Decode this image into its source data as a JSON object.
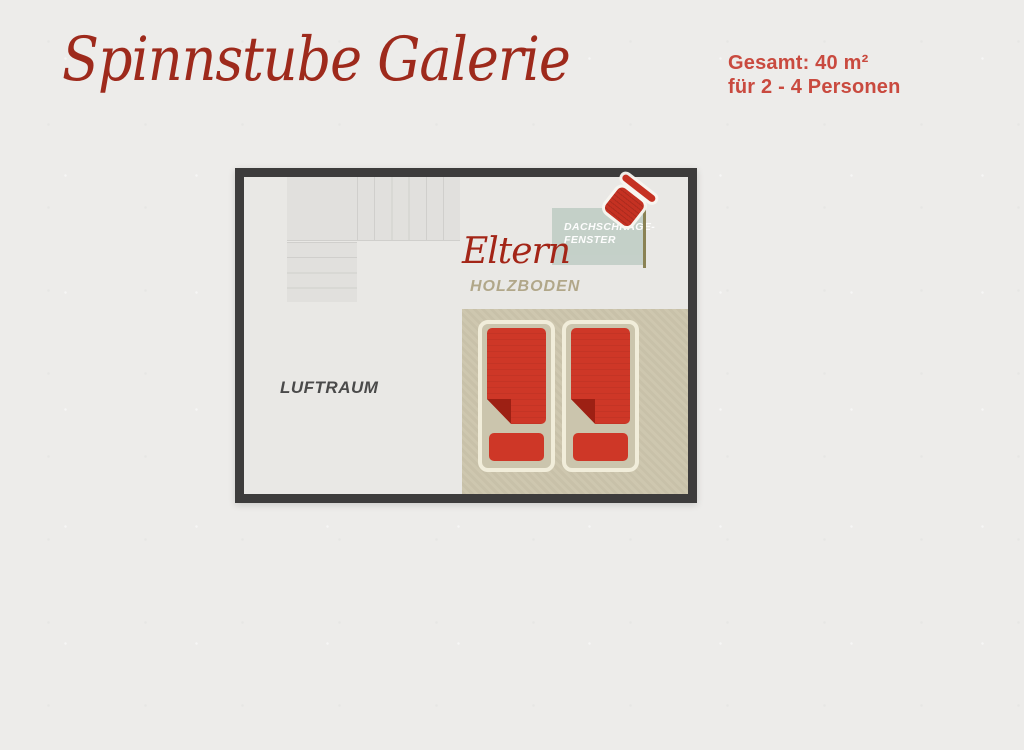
{
  "header": {
    "title": "Spinnstube Galerie",
    "info": {
      "line1": "Gesamt: 40 m²",
      "line2": "für 2 - 4 Personen"
    }
  },
  "floorplan": {
    "labels": {
      "room": "Eltern",
      "floor": "HOLZBODEN",
      "void": "LUFTRAUM",
      "window_line1": "DACHSCHRÄGE-",
      "window_line2": "FENSTER"
    },
    "beds_count": 2,
    "stairs": {
      "upper_run_steps": 6,
      "lower_run_steps": 4
    }
  },
  "colors": {
    "paper": "#edecea",
    "title-red": "#9e2a1c",
    "info-red": "#c94a3f",
    "script-red": "#a32517",
    "border-dark": "#3d3c3c",
    "room-floor": "#e9e8e5",
    "stair-fill": "#e1e0dd",
    "stair-line": "#d0cfcc",
    "wood-floor": "#c8c1a9",
    "wood-floor-light": "#cec7af",
    "sage": "#c3cfc7",
    "olive": "#8a8254",
    "window-text": "#ffffff",
    "spool-red": "#c53122",
    "bed-frame": "#f1edda",
    "bed-inner": "#cbc5ad",
    "blanket-red": "#ce3727",
    "fold-red": "#9d2014",
    "holzboden-text": "#b1a789",
    "luftraum-text": "#4a4a4a"
  }
}
